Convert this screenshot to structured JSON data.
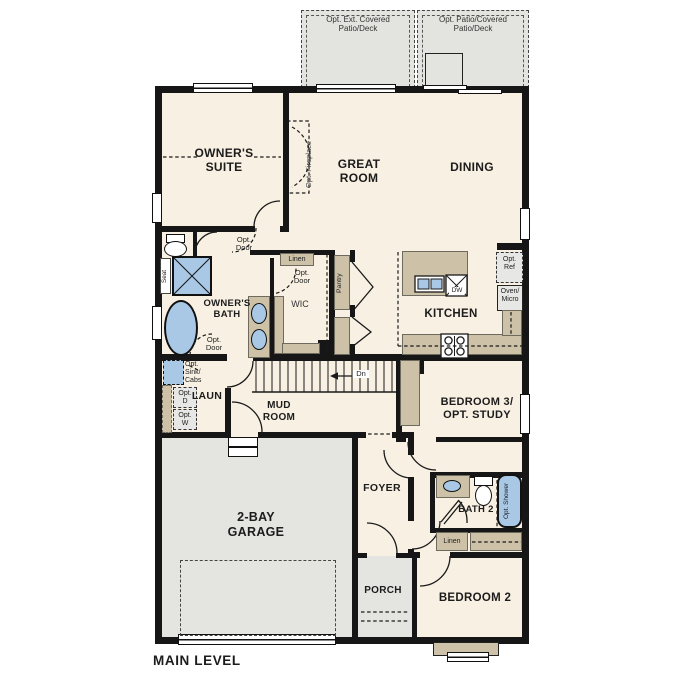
{
  "title": "MAIN LEVEL",
  "areas": {
    "patio_left": "Opt. Ext. Covered\nPatio/Deck",
    "patio_right": "Opt. Patio/Covered\nPatio/Deck"
  },
  "rooms": {
    "owners_suite": "OWNER'S\nSUITE",
    "great_room": "GREAT\nROOM",
    "dining": "DINING",
    "kitchen": "KITCHEN",
    "owners_bath": "OWNER'S\nBATH",
    "wic": "WIC",
    "laundry": "LAUN",
    "mud_room": "MUD\nROOM",
    "bedroom_3": "BEDROOM 3/\nOPT. STUDY",
    "foyer": "FOYER",
    "bath_2": "BATH 2",
    "garage": "2-BAY\nGARAGE",
    "porch": "PORCH",
    "bedroom_2": "BEDROOM 2"
  },
  "annotations": {
    "opt_fireplace": "Opt. Fireplace",
    "opt_door": "Opt.\nDoor",
    "linen": "Linen",
    "pantry": "Pantry",
    "opt_ref": "Opt.\nRef",
    "oven_micro": "Oven/\nMicro",
    "seat": "Seat",
    "opt_sink_cabs": "Opt.\nSink/\nCabs",
    "opt_dryer": "Opt.\nD",
    "opt_washer": "Opt.\nW",
    "down": "Dn",
    "opt_shower": "Opt. Shower",
    "dishwasher": "DW"
  },
  "colors": {
    "wall": "#161616",
    "interior": "#f8f0e2",
    "exterior_gray": "#e3e3e0",
    "cabinet_tan": "#cdc1a7",
    "fixture_blue": "#a9c8e6"
  }
}
